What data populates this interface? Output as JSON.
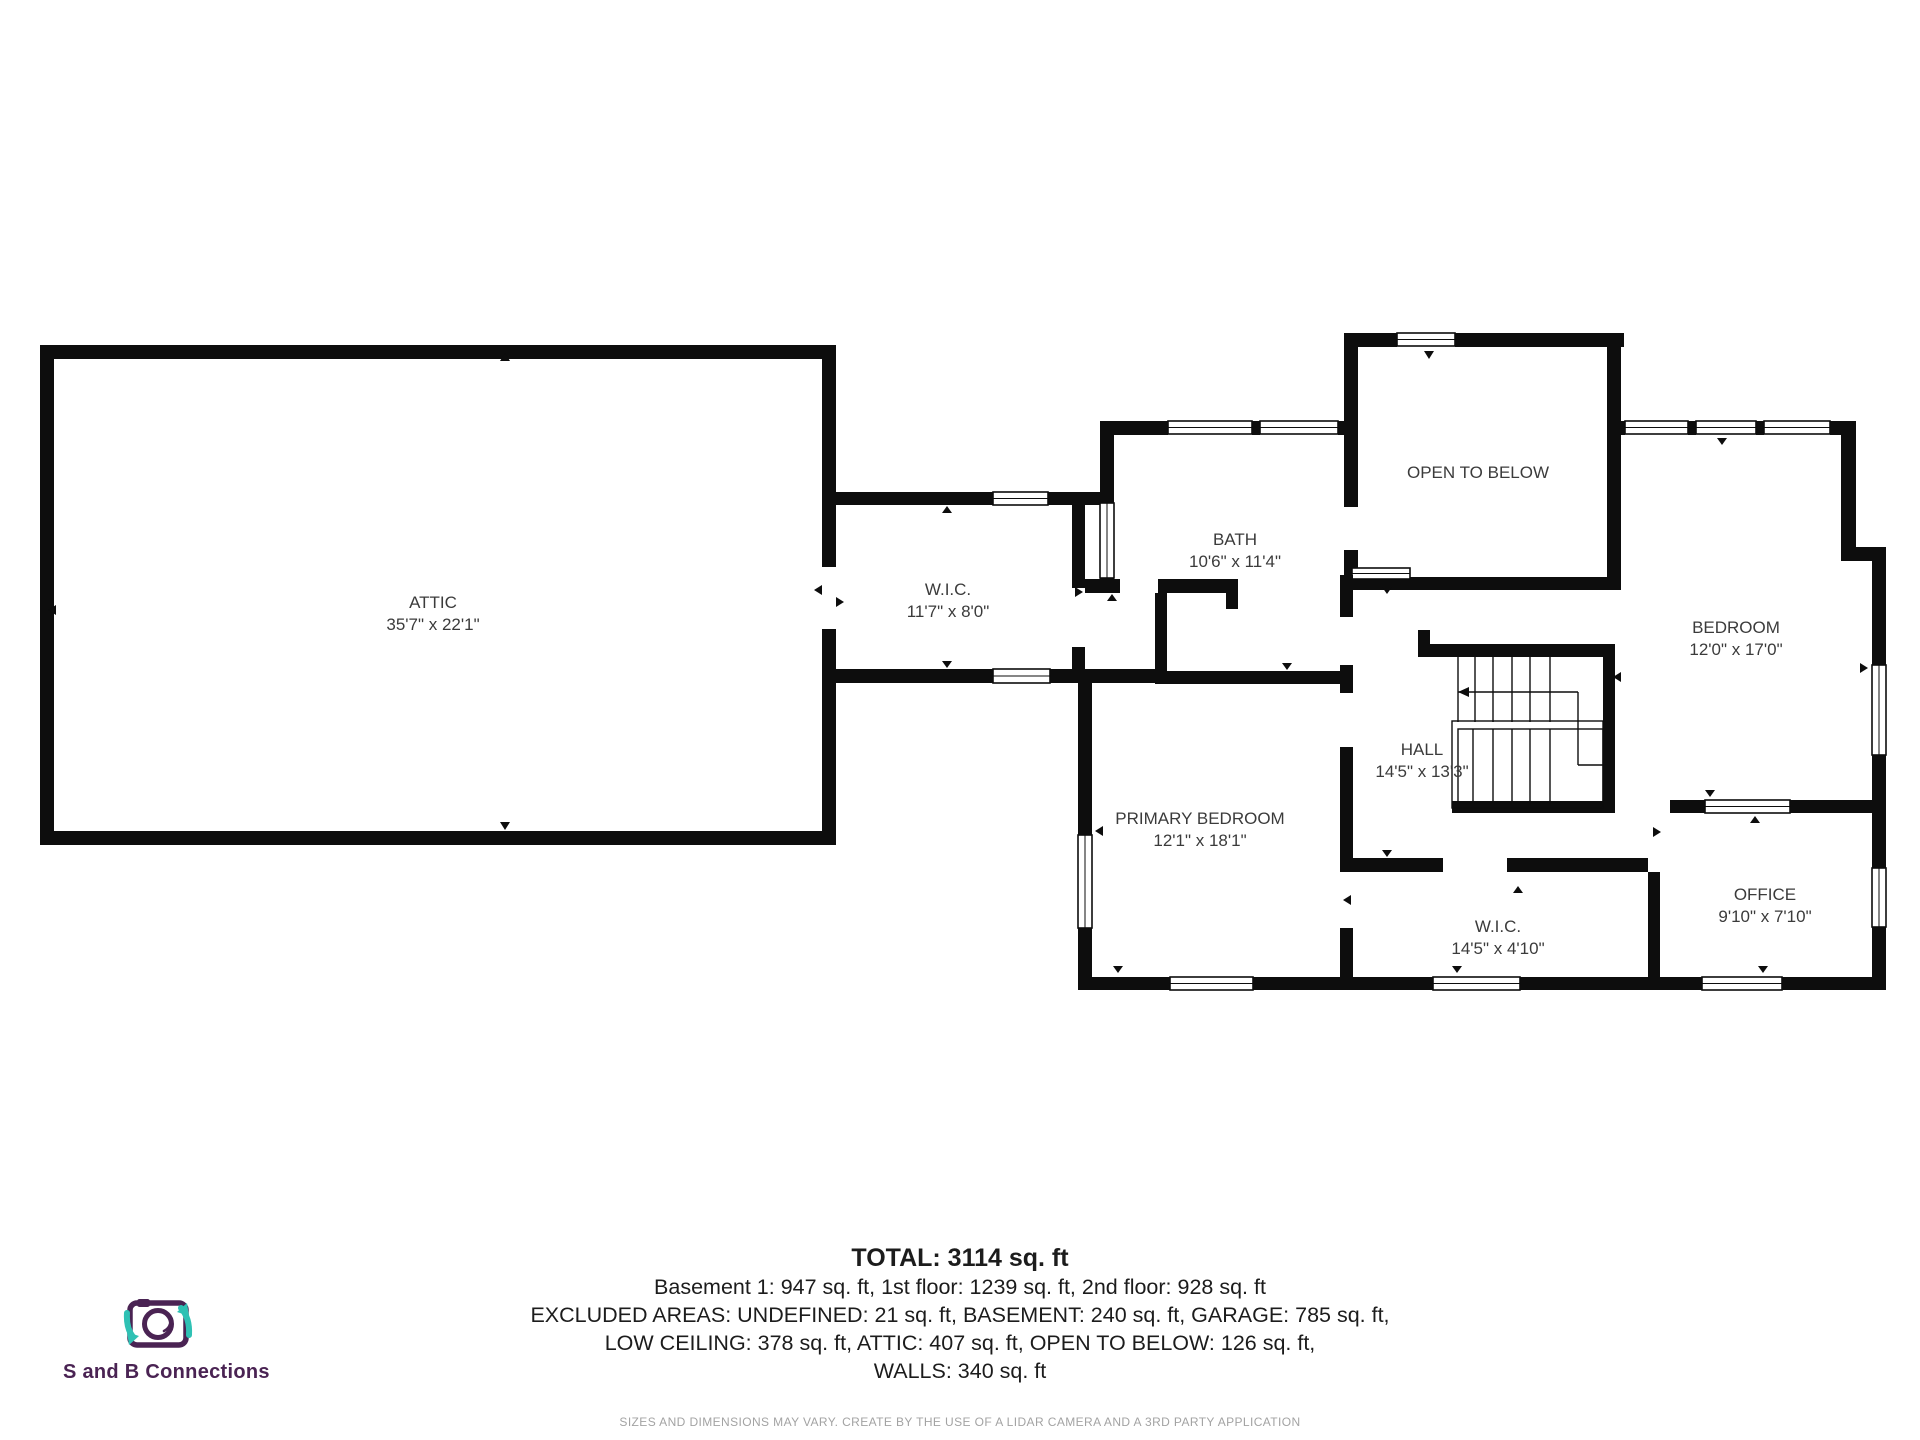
{
  "rooms": [
    {
      "name": "ATTIC",
      "dims": "35'7\" x 22'1\""
    },
    {
      "name": "W.I.C.",
      "dims": "11'7\" x 8'0\""
    },
    {
      "name": "BATH",
      "dims": "10'6\" x 11'4\""
    },
    {
      "name": "OPEN TO BELOW",
      "dims": ""
    },
    {
      "name": "BEDROOM",
      "dims": "12'0\" x 17'0\""
    },
    {
      "name": "HALL",
      "dims": "14'5\" x 13'3\""
    },
    {
      "name": "PRIMARY BEDROOM",
      "dims": "12'1\" x 18'1\""
    },
    {
      "name": "W.I.C.",
      "dims": "14'5\" x 4'10\""
    },
    {
      "name": "OFFICE",
      "dims": "9'10\" x 7'10\""
    }
  ],
  "summary": {
    "total": "TOTAL: 3114 sq. ft",
    "floors": "Basement 1: 947 sq. ft, 1st floor: 1239 sq. ft, 2nd floor: 928 sq. ft",
    "excluded1": "EXCLUDED AREAS: UNDEFINED: 21 sq. ft, BASEMENT: 240 sq. ft, GARAGE: 785 sq. ft,",
    "excluded2": "LOW CEILING: 378 sq. ft, ATTIC: 407 sq. ft, OPEN TO BELOW: 126 sq. ft,",
    "walls": "WALLS: 340 sq. ft"
  },
  "disclaimer": "SIZES AND DIMENSIONS MAY VARY. CREATE BY THE USE OF A LIDAR CAMERA AND A 3RD PARTY APPLICATION",
  "logo": {
    "text": "S and B Connections",
    "icon": "camera-icon"
  },
  "colors": {
    "wall": "#0d0d0d",
    "label": "#3b3b3b",
    "fineprint": "#a3a3a3",
    "logo_purple": "#4a2353",
    "logo_teal": "#2fc1b4"
  }
}
